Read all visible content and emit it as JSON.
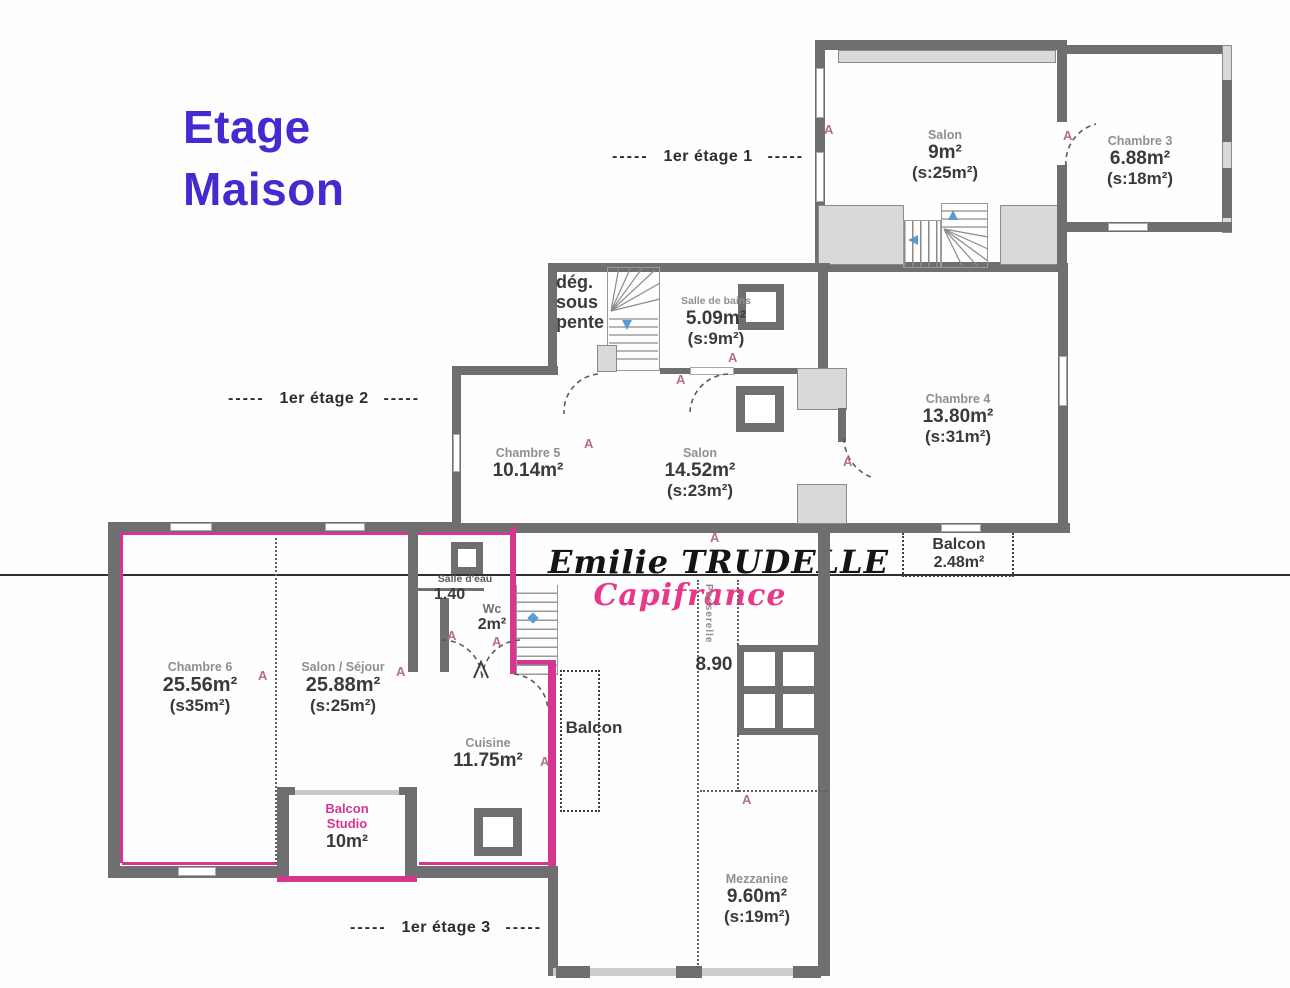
{
  "title": {
    "line1": "Etage",
    "line2": "Maison"
  },
  "floor_labels": {
    "f1_dashes_left": "-----",
    "f1": "1er étage 1",
    "f1_dashes_right": "-----",
    "f2_dashes_left": "-----",
    "f2": "1er étage 2",
    "f2_dashes_right": "-----",
    "f3_dashes_left": "-----",
    "f3": "1er étage 3",
    "f3_dashes_right": "-----"
  },
  "watermark": {
    "agent": "Emilie TRUDELLE",
    "brand": "Capifrance",
    "brand_color": "#e8388a"
  },
  "door_marker": "A",
  "rooms": {
    "salon_etage1": {
      "name": "Salon",
      "area": "9m²",
      "shab": "(s:25m²)"
    },
    "chambre3": {
      "name": "Chambre 3",
      "area": "6.88m²",
      "shab": "(s:18m²)"
    },
    "degagement": {
      "line1": "dég.",
      "line2": "sous",
      "line3": "pente"
    },
    "salle_de_bains": {
      "name": "Salle de bains",
      "area": "5.09m²",
      "shab": "(s:9m²)"
    },
    "chambre4": {
      "name": "Chambre 4",
      "area": "13.80m²",
      "shab": "(s:31m²)"
    },
    "chambre5": {
      "name": "Chambre 5",
      "area": "10.14m²"
    },
    "salon_etage2": {
      "name": "Salon",
      "area": "14.52m²",
      "shab": "(s:23m²)"
    },
    "balcon_etage2": {
      "name": "Balcon",
      "area": "2.48m²"
    },
    "salle_deau": {
      "name": "Salle d'eau",
      "area": "1.40"
    },
    "wc": {
      "name": "Wc",
      "area": "2m²"
    },
    "chambre6": {
      "name": "Chambre 6",
      "area": "25.56m²",
      "shab": "(s35m²)"
    },
    "salon_sejour": {
      "name": "Salon / Séjour",
      "area": "25.88m²",
      "shab": "(s:25m²)"
    },
    "cuisine": {
      "name": "Cuisine",
      "area": "11.75m²"
    },
    "balcon_cuisine": {
      "name": "Balcon"
    },
    "balcon_studio": {
      "line1": "Balcon",
      "line2": "Studio",
      "area": "10m²"
    },
    "mezzanine": {
      "name": "Mezzanine",
      "area": "9.60m²",
      "shab": "(s:19m²)"
    },
    "passerelle": {
      "name": "Passerelle",
      "length": "8.90"
    }
  },
  "colors": {
    "wall": "#6f6f6f",
    "wall_light": "#d9d9d9",
    "studio_outline": "#d6368f",
    "door_marker": "#b4707c",
    "stair_arrow": "#5b9bd5",
    "title": "#4729cf",
    "brand": "#e8388a",
    "boundary_line": "#2f2f2f"
  }
}
